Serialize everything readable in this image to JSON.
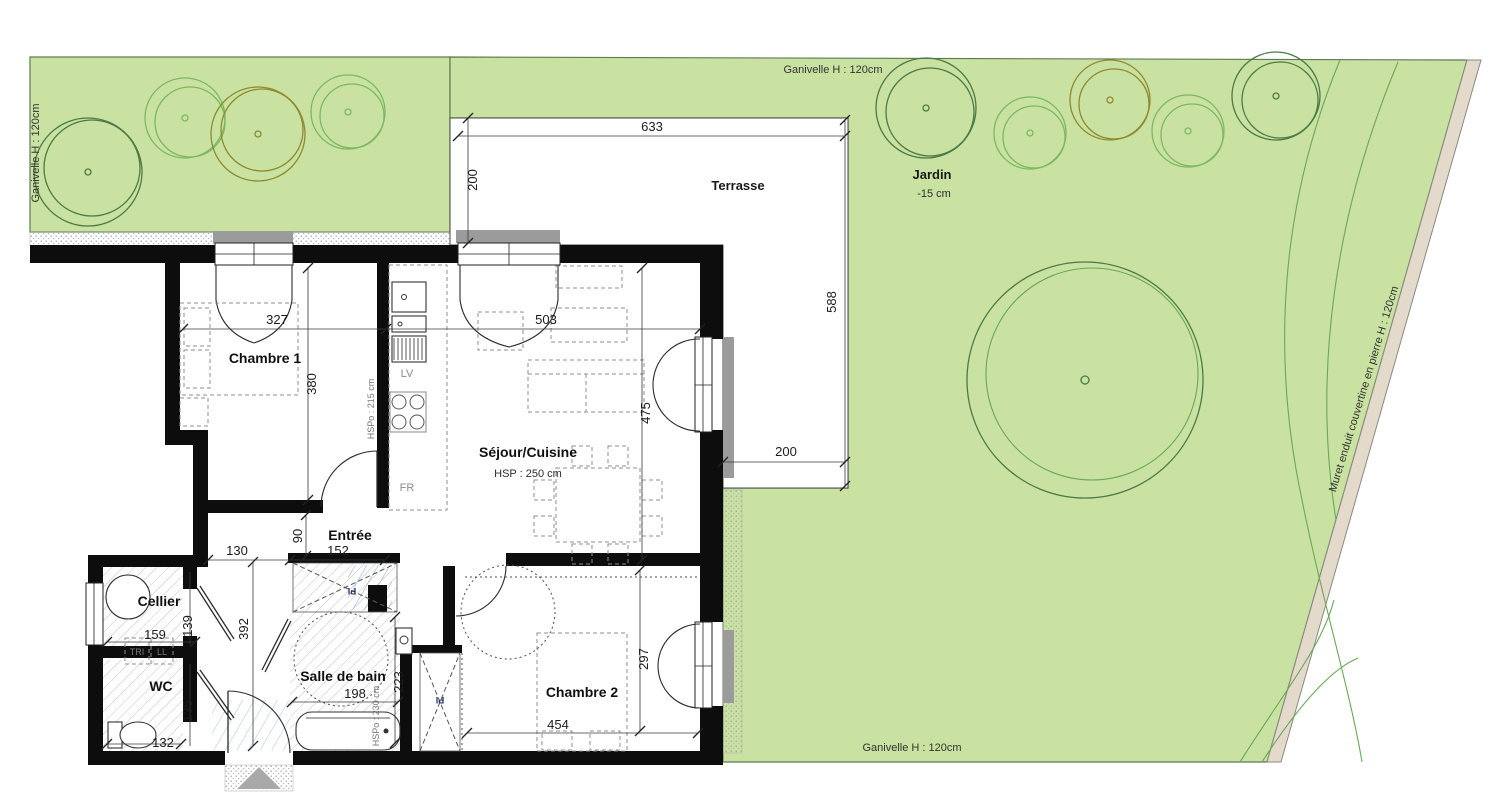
{
  "labels": {
    "ganivelle_top": "Ganivelle H : 120cm",
    "ganivelle_left": "Ganivelle H : 120cm",
    "ganivelle_bottom": "Ganivelle H : 120cm",
    "muret": "Muret enduit couvertine en pierre H : 120cm",
    "jardin": "Jardin",
    "jardin_level": "-15 cm",
    "terrasse": "Terrasse",
    "chambre1": "Chambre 1",
    "sejour": "Séjour/Cuisine",
    "sejour_hsp": "HSP : 250 cm",
    "entree": "Entrée",
    "cellier": "Cellier",
    "wc": "WC",
    "sdb": "Salle de bain",
    "sdb_hspo": "HSPo : 230 cm",
    "kitchen_hspo": "HSPo : 215 cm",
    "chambre2": "Chambre 2",
    "lv": "LV",
    "fr": "FR",
    "tri": "TRI",
    "ll": "LL",
    "pl1": "Pl",
    "pl2": "Pl"
  },
  "dims": {
    "terrasse_w": "633",
    "terrasse_d": "200",
    "terrasse_h": "588",
    "terrasse_b": "200",
    "ch1_w": "327",
    "ch1_h": "380",
    "sej_w": "503",
    "sej_h": "475",
    "ent_a": "130",
    "ent_b": "152",
    "ent_c": "90",
    "corridor": "392",
    "cel_w": "159",
    "cel_h": "139",
    "wc_h": "135",
    "wc_w": "132",
    "sdb_w": "198",
    "sdb_h": "223",
    "ch2_w": "454",
    "ch2_h": "297"
  },
  "colors": {
    "garden": "#c9e2a2",
    "muret": "#e4dacc",
    "tree_dark": "#4c7a45",
    "tree_light": "#7cb862",
    "tree_olive": "#8f8a2f",
    "tree_mid": "#69a855",
    "wall": "#0d0d0d",
    "blue_hatch": "#93abdc"
  }
}
